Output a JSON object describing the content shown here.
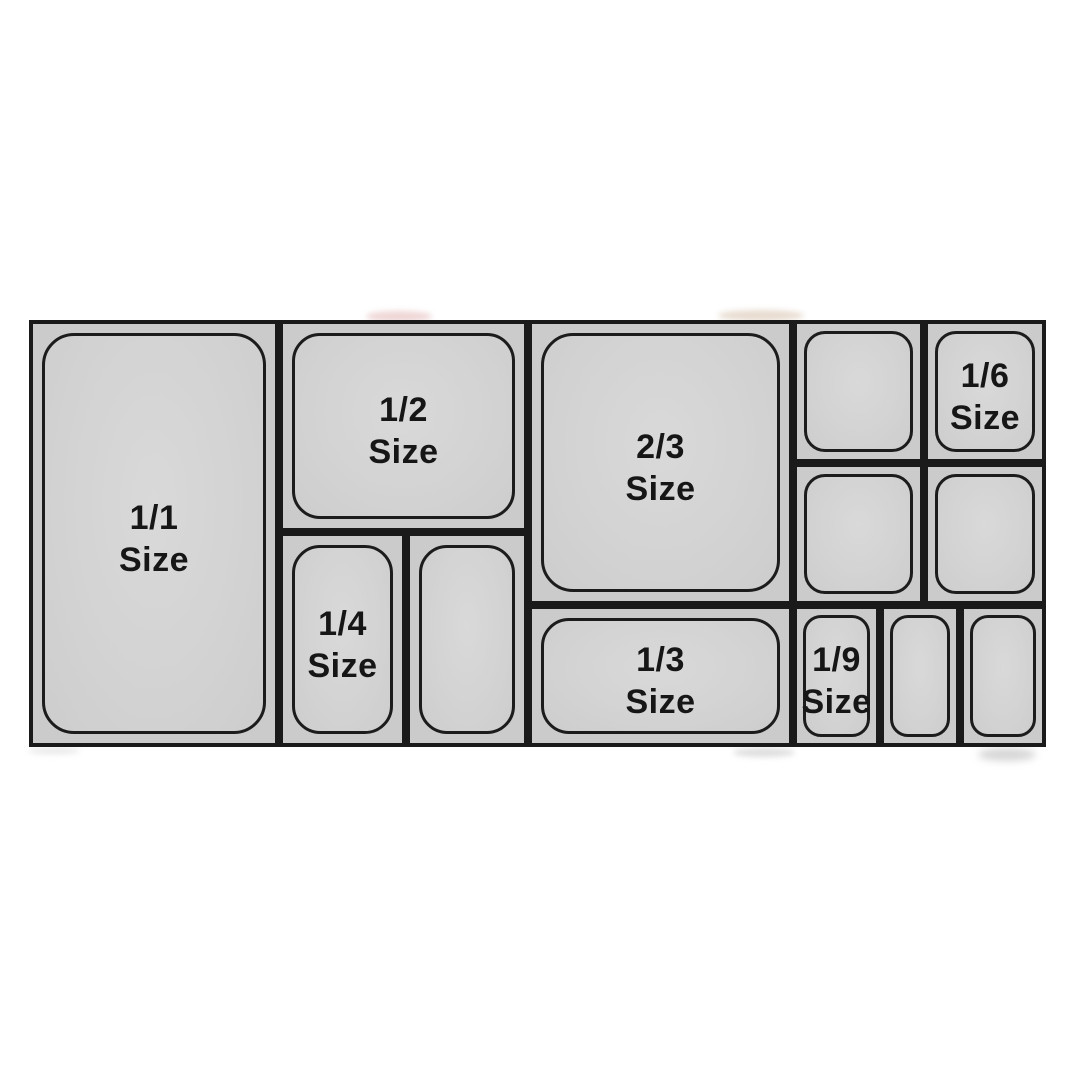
{
  "diagram": {
    "pans": {
      "full": {
        "fraction": "1/1",
        "word": "Size"
      },
      "half": {
        "fraction": "1/2",
        "word": "Size"
      },
      "quarter": {
        "fraction": "1/4",
        "word": "Size"
      },
      "two_thirds": {
        "fraction": "2/3",
        "word": "Size"
      },
      "third": {
        "fraction": "1/3",
        "word": "Size"
      },
      "sixth": {
        "fraction": "1/6",
        "word": "Size"
      },
      "ninth": {
        "fraction": "1/9",
        "word": "Size"
      }
    },
    "colors": {
      "background": "#ffffff",
      "pan_fill": "#d3d3d3",
      "pan_rim": "#cbcbcb",
      "outline": "#1a1a1a",
      "label_text": "#161616"
    }
  }
}
